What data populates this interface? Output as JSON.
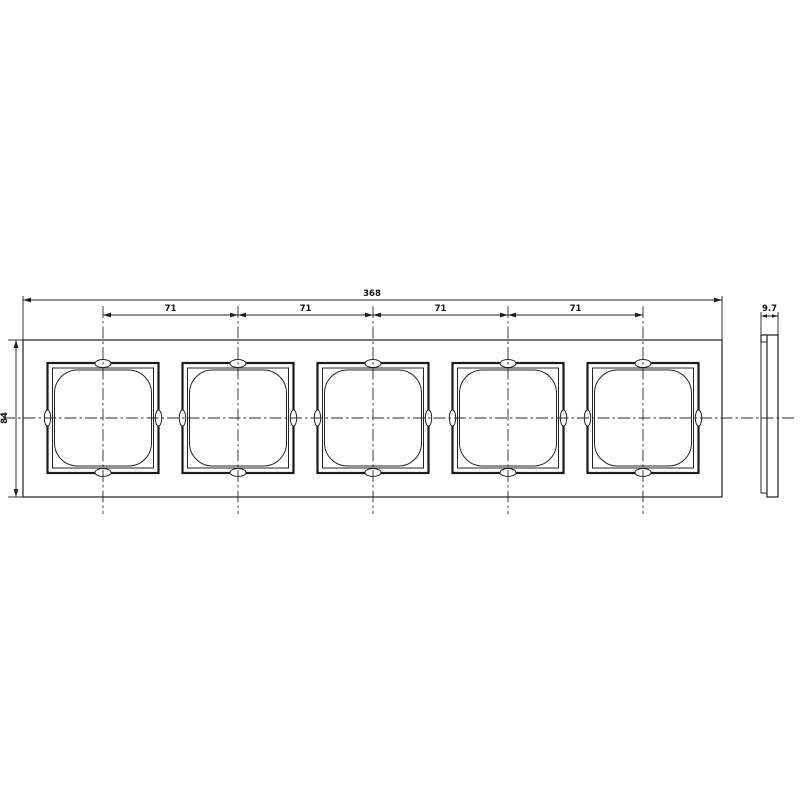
{
  "drawing": {
    "type": "technical-dimension-drawing",
    "front_view": {
      "total_width_label": "368",
      "pitch_labels": [
        "71",
        "71",
        "71",
        "71"
      ],
      "height_label": "84"
    },
    "side_view": {
      "depth_label": "9.7"
    },
    "colors": {
      "line": "#1f1f1f",
      "centerline": "#2b2b2b",
      "background": "#ffffff"
    }
  }
}
